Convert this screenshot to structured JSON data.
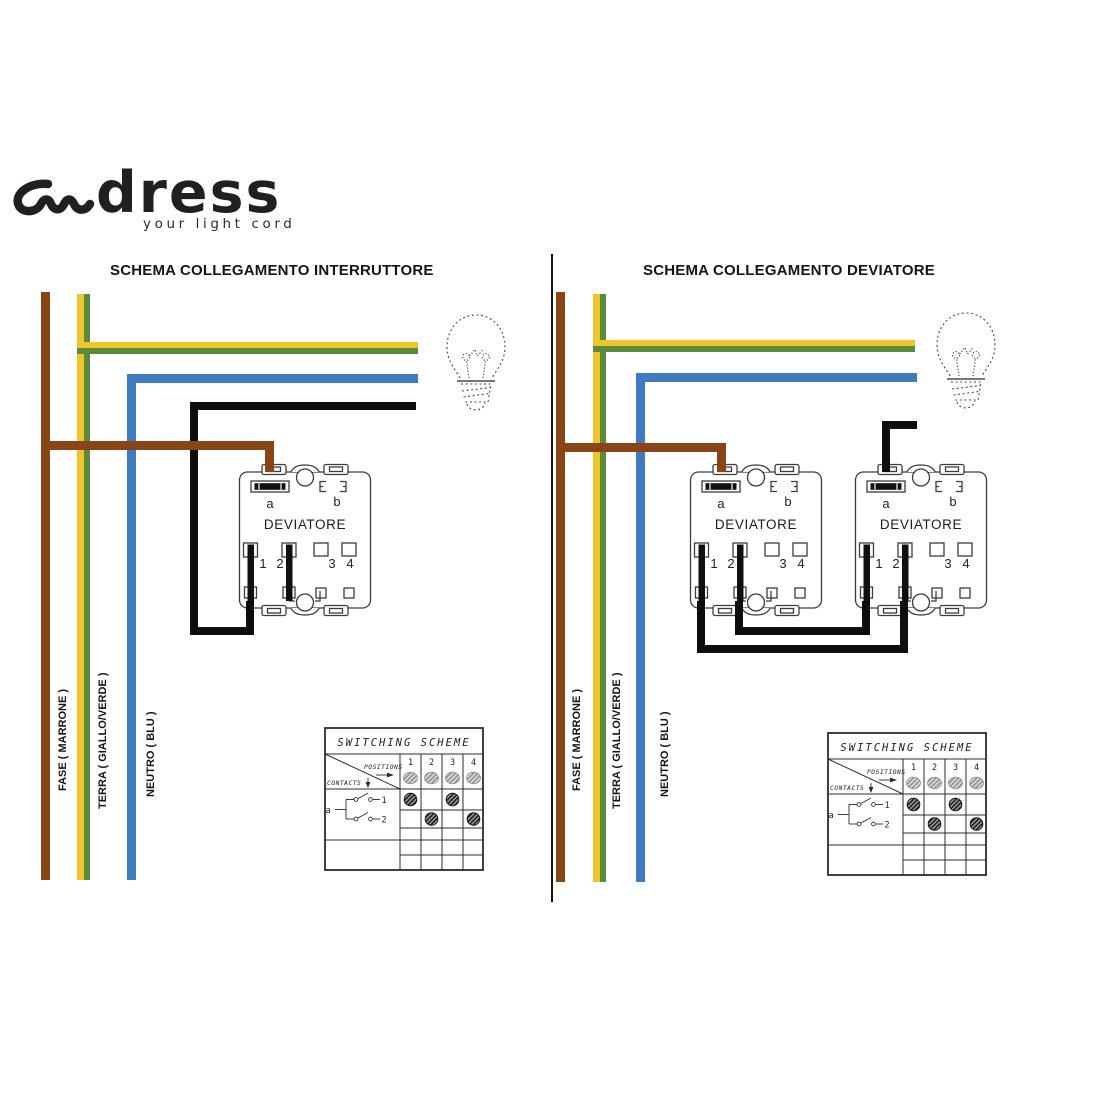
{
  "logo": {
    "brand": "dress",
    "tagline": "your light cord"
  },
  "colors": {
    "fase_brown": "#8a4516",
    "terra_yellow": "#eec52a",
    "terra_green": "#5b8a3a",
    "neutro_blue": "#3f7cbf",
    "wire_black": "#0d0d0d"
  },
  "panels": {
    "left": {
      "title": "SCHEMA COLLEGAMENTO INTERRUTTORE"
    },
    "right": {
      "title": "SCHEMA COLLEGAMENTO DEVIATORE"
    }
  },
  "wire_labels": {
    "fase": "FASE ( MARRONE )",
    "terra": "TERRA ( GIALLO/VERDE )",
    "neutro": "NEUTRO ( BLU )"
  },
  "switch": {
    "name": "DEVIATORE",
    "terminal_a": "a",
    "terminal_b": "b",
    "terminal_1": "1",
    "terminal_2": "2",
    "terminal_3": "3",
    "terminal_4": "4"
  },
  "switching_table": {
    "title": "SWITCHING SCHEME",
    "positions_label": "POSITIONS",
    "contacts_label": "CONTACTS",
    "contact_group_label": "a",
    "position_columns": [
      "1",
      "2",
      "3",
      "4"
    ],
    "contact_rows": [
      "1",
      "2"
    ],
    "active_cells": [
      {
        "contact": "1",
        "position": "1"
      },
      {
        "contact": "1",
        "position": "3"
      },
      {
        "contact": "2",
        "position": "2"
      },
      {
        "contact": "2",
        "position": "4"
      }
    ]
  }
}
